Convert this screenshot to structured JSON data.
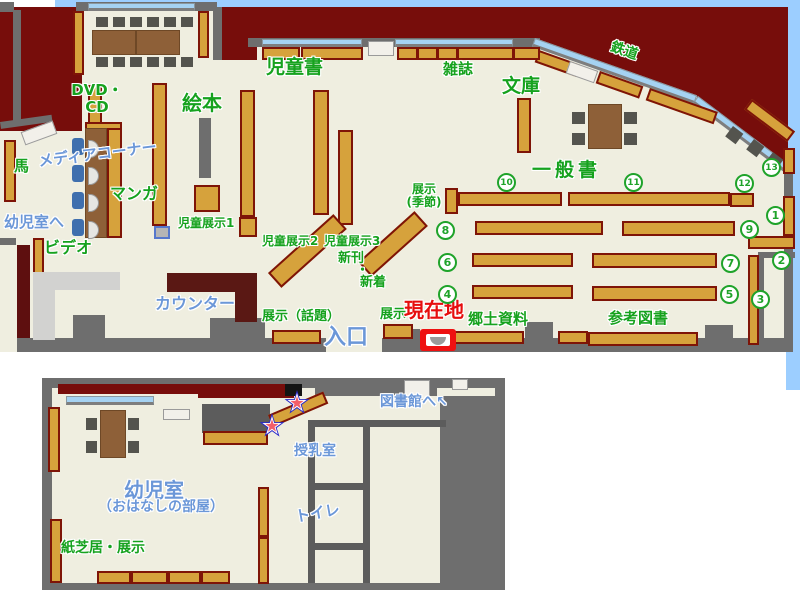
{
  "colors": {
    "outside": "#770d0b",
    "floor": "#efeee0",
    "wall": "#6e6e6e",
    "sky": "#9cceff",
    "shelf": "#d6a23c",
    "shelf_border": "#7e1407",
    "window": "#a5d2f2",
    "accent_green": "#16a21e",
    "accent_blue": "#6b97d8",
    "accent_red": "#e60e0e",
    "star_outline": "#2a2ac8",
    "star_fill": "#f25f6a",
    "marker_red": "#ee1111"
  },
  "main_map": {
    "labels": {
      "jidosho": "児童書",
      "zasshi": "雑誌",
      "bunko": "文庫",
      "tetsudo": "鉄道",
      "dvd_line1": "DVD・",
      "dvd_line2": "CD",
      "ehon": "絵本",
      "media_corner": "メディアコーナー",
      "manga": "マンガ",
      "uma": "馬",
      "to_yojishitsu": "幼児室へ",
      "video": "ビデオ",
      "jido_tenji1": "児童展示1",
      "jido_tenji2": "児童展示2",
      "jido_tenji3": "児童展示3",
      "shinkan": "新刊",
      "dot": "・",
      "shinchaku": "新着",
      "counter": "カウンター",
      "tenji_wadai": "展示（話題）",
      "iriguchi": "入口",
      "tenji": "展示",
      "genzaichi": "現在地",
      "kyodo_shiryo": "郷土資料",
      "sanko_tosho": "参考図書",
      "ippansho": "一般書",
      "tenji_kisetsu_l1": "展示",
      "tenji_kisetsu_l2": "(季節)"
    },
    "numbers": {
      "n1": "1",
      "n2": "2",
      "n3": "3",
      "n4": "4",
      "n5": "5",
      "n6": "6",
      "n7": "7",
      "n8": "8",
      "n9": "9",
      "n10": "10",
      "n11": "11",
      "n12": "12",
      "n13": "13"
    }
  },
  "sub_map": {
    "labels": {
      "toshokan_e": "図書館へ",
      "arrow": "↖",
      "junyushitsu": "授乳室",
      "toire": "トイレ",
      "yojishitsu": "幼児室",
      "ohanashi": "（おはなしの部屋）",
      "kamishibai": "紙芝居・展示"
    }
  }
}
